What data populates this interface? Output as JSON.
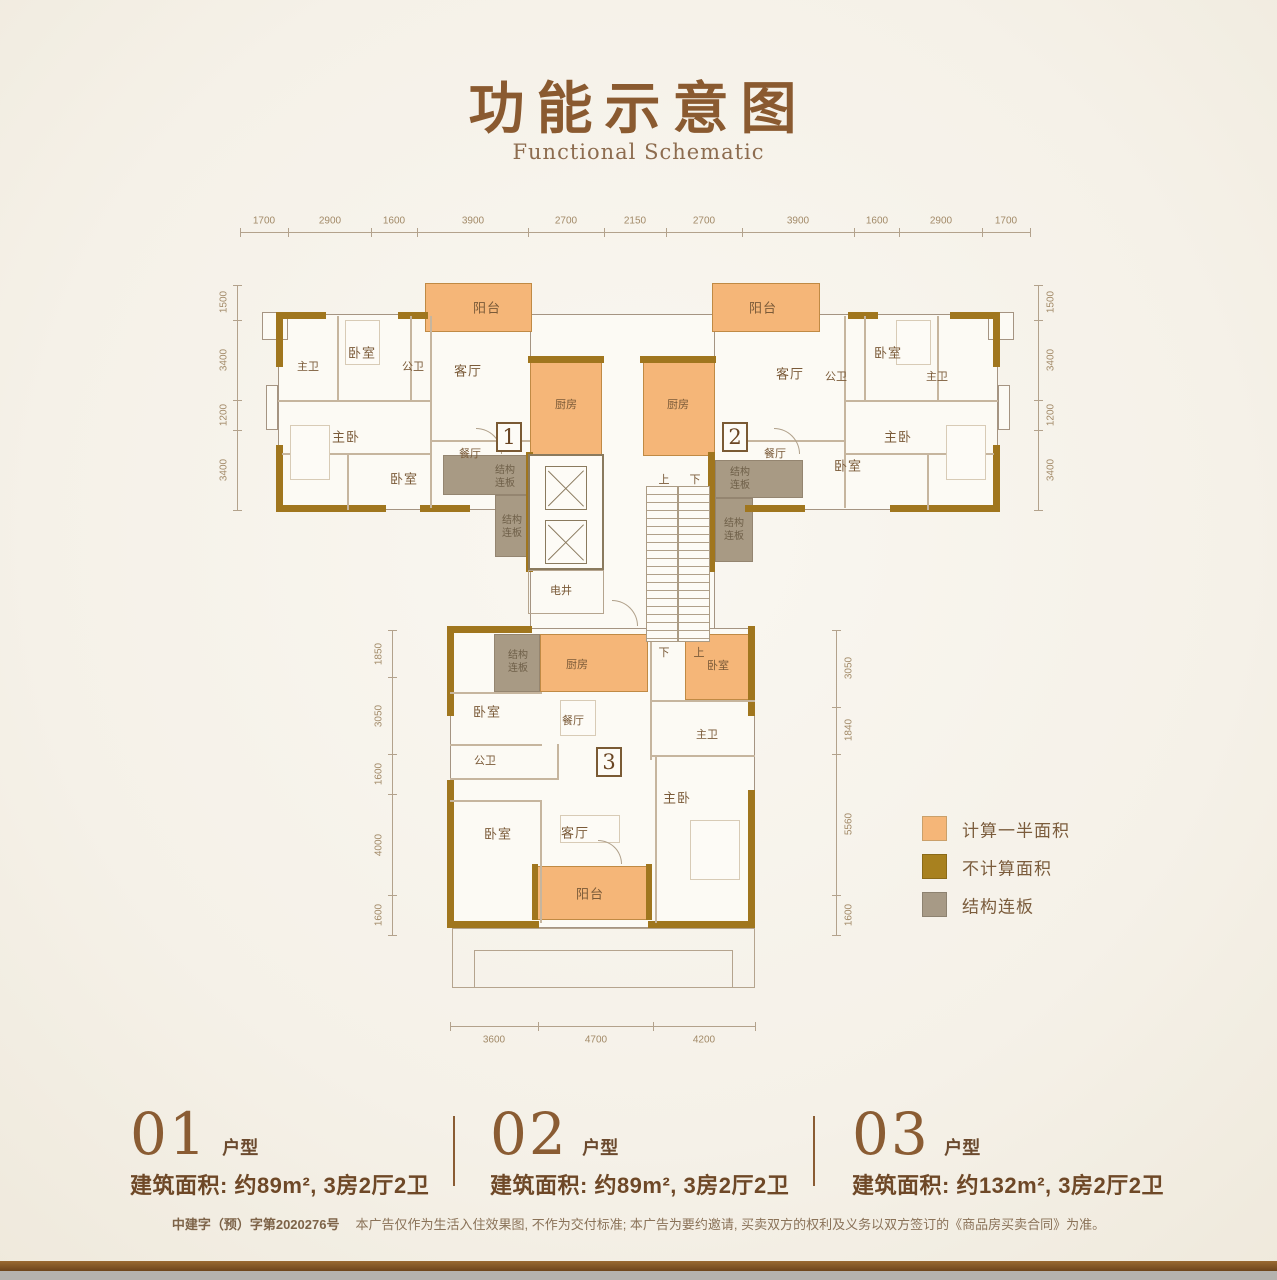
{
  "title": {
    "zh": "功能示意图",
    "en": "Functional Schematic"
  },
  "legend": {
    "items": [
      {
        "label": "计算一半面积",
        "color": "#f5b678"
      },
      {
        "label": "不计算面积",
        "color": "#a8811f"
      },
      {
        "label": "结构连板",
        "color": "#a79a86"
      }
    ]
  },
  "units_info": {
    "items": [
      {
        "number": "01",
        "type_suffix": "户型",
        "area_info": "建筑面积: 约89m², 3房2厅2卫"
      },
      {
        "number": "02",
        "type_suffix": "户型",
        "area_info": "建筑面积: 约89m², 3房2厅2卫"
      },
      {
        "number": "03",
        "type_suffix": "户型",
        "area_info": "建筑面积: 约132m², 3房2厅2卫"
      }
    ]
  },
  "footer": {
    "permit": "中建字（预）字第2020276号",
    "disclaimer": "本广告仅作为生活入住效果图, 不作为交付标准; 本广告为要约邀请, 买卖双方的权利及义务以双方签订的《商品房买卖合同》为准。"
  },
  "dimensions": {
    "top": [
      "1700",
      "2900",
      "1600",
      "3900",
      "2700",
      "2150",
      "2700",
      "3900",
      "1600",
      "2900",
      "1700"
    ],
    "upper_left": [
      "1500",
      "3400",
      "1200",
      "3400"
    ],
    "upper_right": [
      "1500",
      "3400",
      "1200",
      "3400"
    ],
    "lower_left": [
      "1850",
      "3050",
      "1600",
      "4000",
      "1600"
    ],
    "lower_right": [
      "3050",
      "1840",
      "5560",
      "1600"
    ],
    "bottom": [
      "3600",
      "4700",
      "4200"
    ]
  },
  "plan": {
    "unit_markers": {
      "u1": "1",
      "u2": "2",
      "u3": "3"
    },
    "rooms": {
      "master_bath": "主卫",
      "bedroom": "卧室",
      "public_bath": "公卫",
      "living_room": "客厅",
      "balcony": "阳台",
      "dining_room": "餐厅",
      "master_bedroom": "主卧",
      "kitchen": "厨房"
    },
    "core": {
      "electric_shaft": "电井",
      "up": "上",
      "down": "下",
      "connector": "结构\n连板"
    }
  },
  "colors": {
    "accent_brown": "#8a5a30",
    "wall_gold": "#a0761e",
    "half_area_orange": "#f5b678",
    "no_count_gold": "#a8811f",
    "connector_gray": "#a79a86"
  }
}
